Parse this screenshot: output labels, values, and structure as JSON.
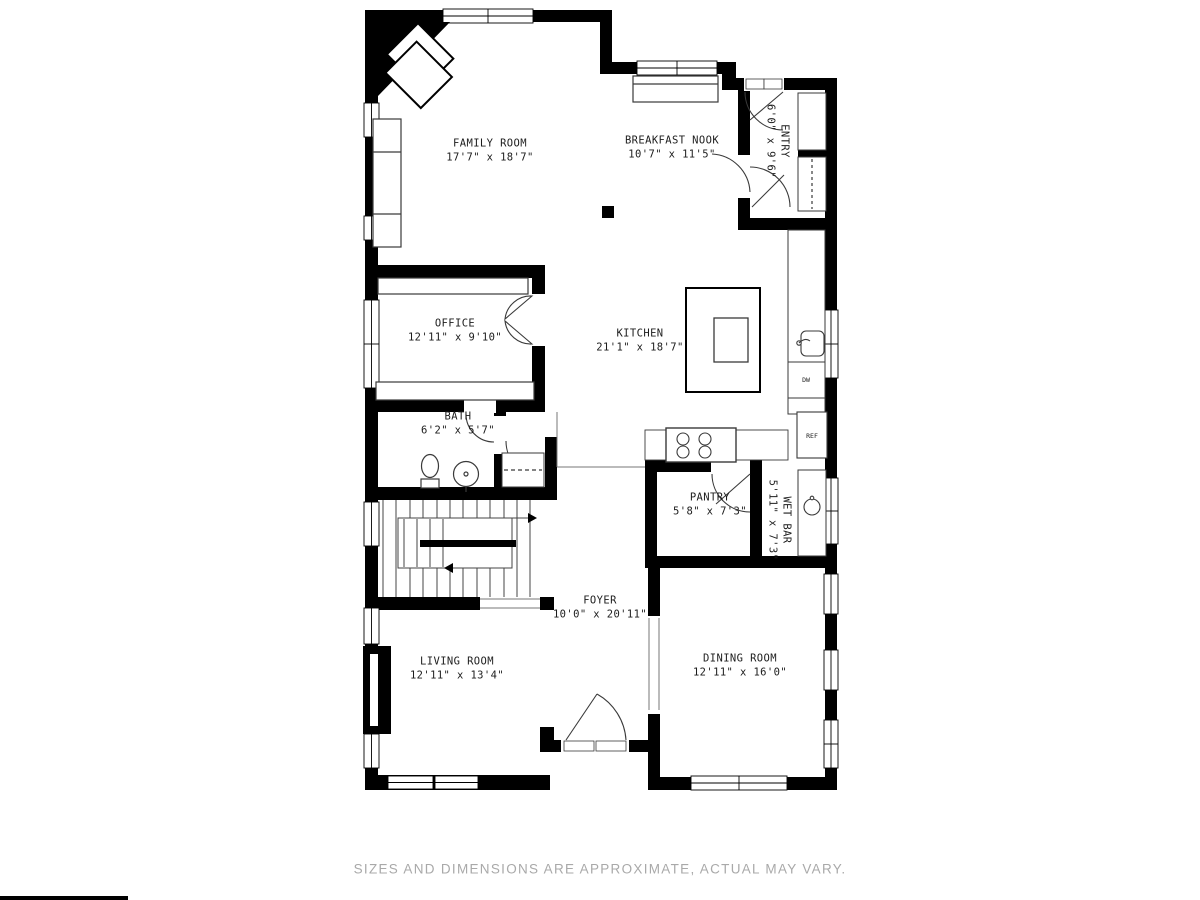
{
  "disclaimer": "SIZES AND DIMENSIONS ARE APPROXIMATE, ACTUAL MAY VARY.",
  "rooms": [
    {
      "id": "family-room",
      "name": "FAMILY ROOM",
      "dims": "17'7\" x 18'7\"",
      "rotated": false
    },
    {
      "id": "breakfast-nook",
      "name": "BREAKFAST NOOK",
      "dims": "10'7\" x 11'5\"",
      "rotated": false
    },
    {
      "id": "entry",
      "name": "ENTRY",
      "dims": "6'0\" x 9'6\"",
      "rotated": true
    },
    {
      "id": "office",
      "name": "OFFICE",
      "dims": "12'11\" x 9'10\"",
      "rotated": false
    },
    {
      "id": "kitchen",
      "name": "KITCHEN",
      "dims": "21'1\" x 18'7\"",
      "rotated": false
    },
    {
      "id": "bath",
      "name": "BATH",
      "dims": "6'2\" x 5'7\"",
      "rotated": false
    },
    {
      "id": "pantry",
      "name": "PANTRY",
      "dims": "5'8\" x 7'3\"",
      "rotated": false
    },
    {
      "id": "wet-bar",
      "name": "WET BAR",
      "dims": "5'11\" x 7'3\"",
      "rotated": true
    },
    {
      "id": "foyer",
      "name": "FOYER",
      "dims": "10'0\" x 20'11\"",
      "rotated": false
    },
    {
      "id": "living-room",
      "name": "LIVING ROOM",
      "dims": "12'11\" x 13'4\"",
      "rotated": false
    },
    {
      "id": "dining-room",
      "name": "DINING ROOM",
      "dims": "12'11\" x 16'0\"",
      "rotated": false
    }
  ],
  "fixtures": [
    {
      "id": "refrigerator",
      "label": "REF"
    },
    {
      "id": "dishwasher",
      "label": "DW"
    }
  ],
  "colors": {
    "wall": "#000000",
    "thin_line": "#3a3a3a",
    "label": "#1c1c1c",
    "disclaimer": "#a9a9a9"
  }
}
